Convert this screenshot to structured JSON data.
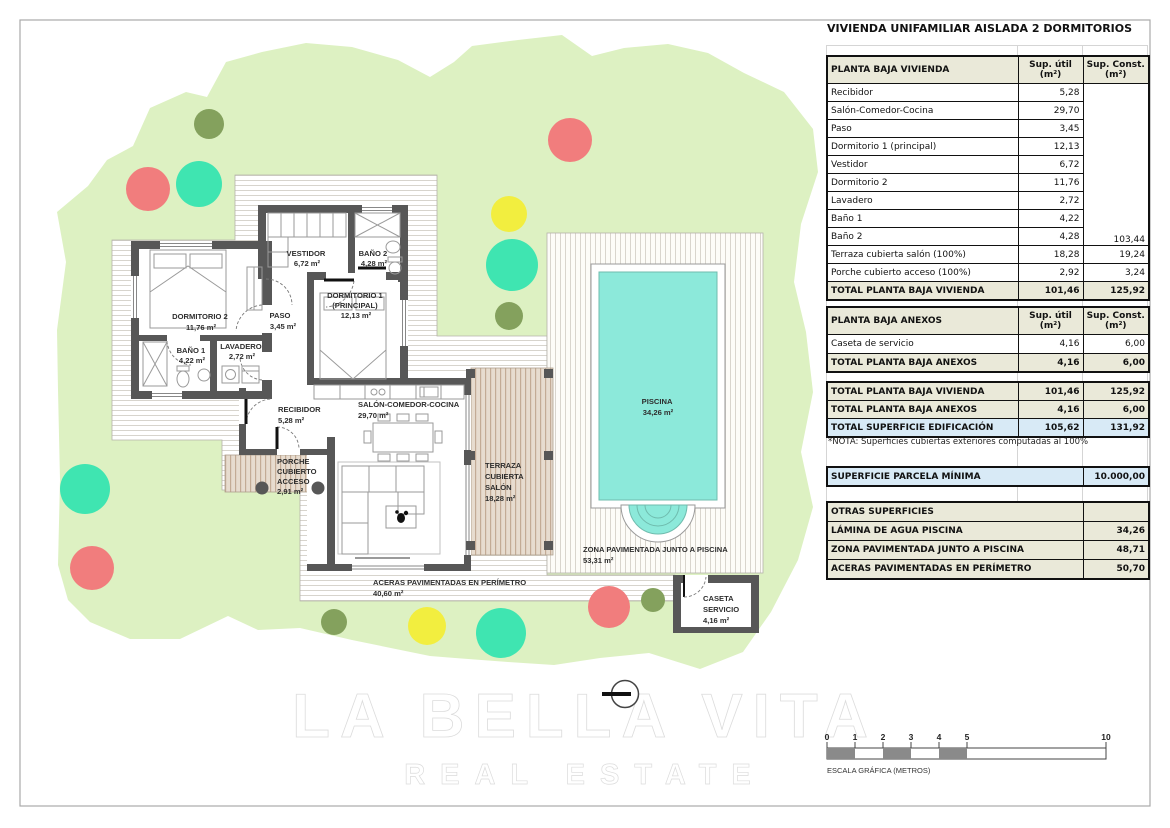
{
  "panel": {
    "title": "VIVIENDA UNIFAMILIAR AISLADA 2 DORMITORIOS",
    "vivienda": {
      "name_header": "PLANTA BAJA VIVIENDA",
      "util_header": "Sup. útil\n(m²)",
      "const_header": "Sup. Const.\n(m²)",
      "rows": [
        {
          "name": "Recibidor",
          "util": "5,28"
        },
        {
          "name": "Salón-Comedor-Cocina",
          "util": "29,70"
        },
        {
          "name": "Paso",
          "util": "3,45"
        },
        {
          "name": "Dormitorio 1 (principal)",
          "util": "12,13"
        },
        {
          "name": "Vestidor",
          "util": "6,72"
        },
        {
          "name": "Dormitorio 2",
          "util": "11,76"
        },
        {
          "name": "Lavadero",
          "util": "2,72"
        },
        {
          "name": "Baño 1",
          "util": "4,22"
        },
        {
          "name": "Baño 2",
          "util": "4,28"
        },
        {
          "name": "Terraza cubierta salón (100%)",
          "util": "18,28",
          "const": "19,24"
        },
        {
          "name": "Porche cubierto acceso (100%)",
          "util": "2,92",
          "const": "3,24"
        }
      ],
      "merged_const": "103,44",
      "total": {
        "name": "TOTAL PLANTA BAJA VIVIENDA",
        "util": "101,46",
        "const": "125,92"
      }
    },
    "anexos": {
      "name_header": "PLANTA BAJA ANEXOS",
      "util_header": "Sup. útil\n(m²)",
      "const_header": "Sup. Const.\n(m²)",
      "rows": [
        {
          "name": "Caseta de servicio",
          "util": "4,16",
          "const": "6,00"
        }
      ],
      "total": {
        "name": "TOTAL PLANTA BAJA ANEXOS",
        "util": "4,16",
        "const": "6,00"
      }
    },
    "summary": {
      "rows": [
        {
          "name": "TOTAL PLANTA BAJA VIVIENDA",
          "util": "101,46",
          "const": "125,92"
        },
        {
          "name": "TOTAL PLANTA BAJA ANEXOS",
          "util": "4,16",
          "const": "6,00"
        },
        {
          "name": "TOTAL SUPERFICIE EDIFICACIÓN",
          "util": "105,62",
          "const": "131,92"
        }
      ],
      "note": "*NOTA: Superficies cubiertas exteriores computadas al 100%"
    },
    "parcela": {
      "name": "SUPERFICIE PARCELA MÍNIMA",
      "value": "10.000,00"
    },
    "otras": {
      "header": "OTRAS SUPERFICIES",
      "rows": [
        {
          "name": "LÁMINA DE AGUA PISCINA",
          "value": "34,26"
        },
        {
          "name": "ZONA PAVIMENTADA JUNTO A PISCINA",
          "value": "48,71"
        },
        {
          "name": "ACERAS PAVIMENTADAS EN PERÍMETRO",
          "value": "50,70"
        }
      ]
    }
  },
  "plan": {
    "rooms": [
      {
        "name": "VESTIDOR",
        "area": "6,72 m²"
      },
      {
        "name": "BAÑO 2",
        "area": "4,28 m²"
      },
      {
        "l1": "DORMITORIO 1",
        "l2": "(PRINCIPAL)",
        "area": "12,13 m²"
      },
      {
        "name": "DORMITORIO 2",
        "area": "11,76 m²"
      },
      {
        "name": "PASO",
        "area": "3,45 m²"
      },
      {
        "name": "BAÑO 1",
        "area": "4,22 m²"
      },
      {
        "name": "LAVADERO",
        "area": "2,72 m²"
      },
      {
        "name": "RECIBIDOR",
        "area": "5,28 m²"
      },
      {
        "name": "SALÓN-COMEDOR-COCINA",
        "area": "29,70 m²"
      }
    ],
    "outdoor": [
      {
        "l1": "PORCHE",
        "l2": "CUBIERTO",
        "l3": "ACCESO",
        "area": "2,91 m²"
      },
      {
        "l1": "TERRAZA",
        "l2": "CUBIERTA",
        "l3": "SALÓN",
        "area": "18,28 m²"
      },
      {
        "l1": "ACERAS PAVIMENTADAS EN PERÍMETRO",
        "area": "40,60 m²"
      },
      {
        "l1": "ZONA PAVIMENTADA JUNTO A PISCINA",
        "area": "53,31 m²"
      },
      {
        "l1": "PISCINA",
        "area": "34,26 m²"
      },
      {
        "l1": "CASETA",
        "l2": "SERVICIO",
        "area": "4,16 m²"
      }
    ]
  },
  "scale_bar": {
    "labels": [
      "0",
      "1",
      "2",
      "3",
      "4",
      "5",
      "10"
    ],
    "caption": "ESCALA GRÁFICA (METROS)"
  },
  "watermark": {
    "line1": "LA BELLA VITA",
    "line2": "REAL ESTATE"
  },
  "colors": {
    "parcel_green": "#ddf1c2",
    "tree_red": "#f17d7d",
    "tree_teal": "#3fe5b1",
    "tree_yellow": "#f2ee3f",
    "tree_olive": "#84a15d",
    "pool_water": "#8ce9da",
    "wall_gray": "#575757",
    "terrace_tan": "#cbb49c",
    "table_header_beige": "#eae9d9",
    "table_highlight_blue": "#d8eaf6",
    "scale_bar_gray": "#8a8a8a"
  }
}
